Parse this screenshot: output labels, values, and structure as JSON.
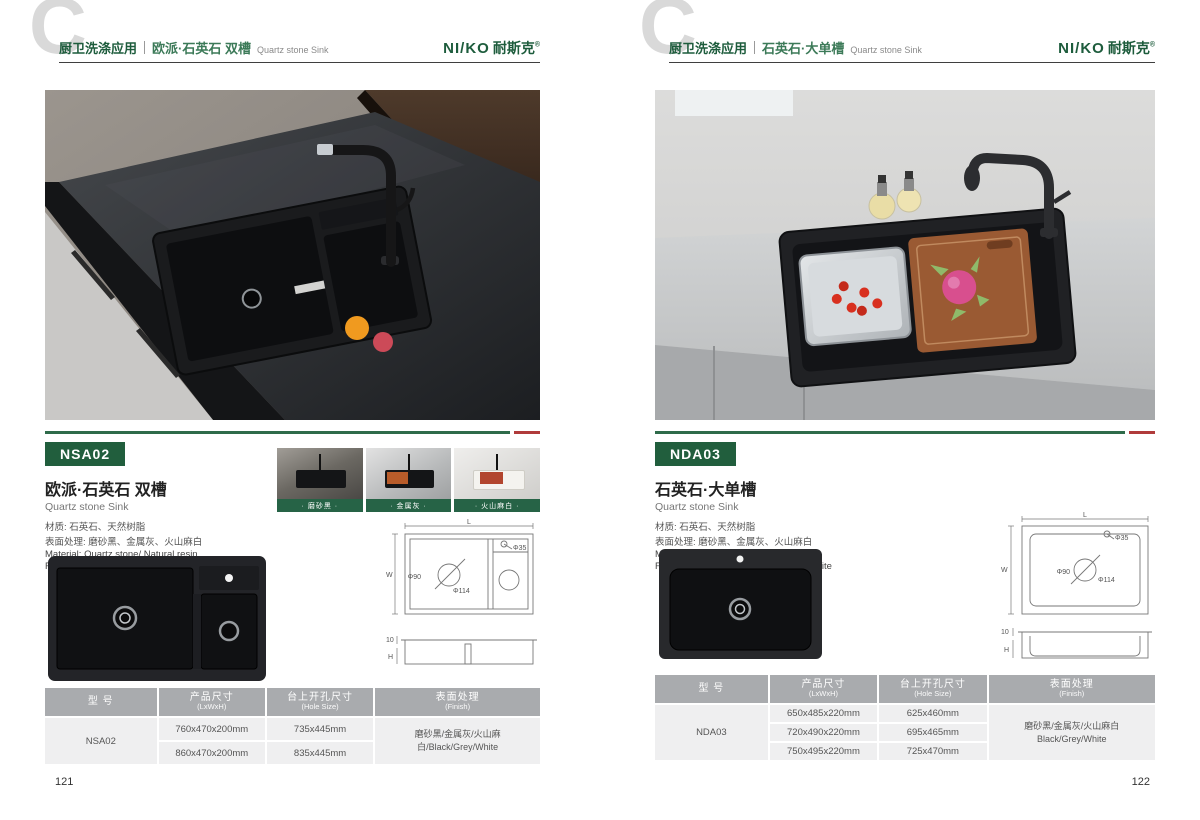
{
  "brand": {
    "logo_latin": "NI/KO",
    "logo_cn": "耐斯克",
    "registered": "®"
  },
  "colors": {
    "brand_green": "#1d5c3c",
    "accent_red": "#b03b3b",
    "table_header_gray": "#a9abae"
  },
  "pages": [
    {
      "page_number": "121",
      "header": {
        "watermark": "C",
        "category": "厨卫洗涤应用",
        "title_cn": "欧派·石英石 双槽",
        "title_en": "Quartz stone Sink"
      },
      "product": {
        "model": "NSA02",
        "name_cn": "欧派·石英石 双槽",
        "name_en": "Quartz stone Sink",
        "material_cn": "材质: 石英石、天然树脂",
        "finish_cn": "表面处理: 磨砂黑、金属灰、火山麻白",
        "material_en": "Material: Quartz stone/ Natural resin",
        "finish_en": "Finish: Frosted black/Metal gray/Dot white"
      },
      "swatches": [
        {
          "label": "· 磨砂黑 ·"
        },
        {
          "label": "· 金属灰 ·"
        },
        {
          "label": "· 火山麻白 ·"
        }
      ],
      "drawing": {
        "length": "L",
        "width": "W",
        "height": "H",
        "lip": "10",
        "hole_faucet": "Φ35",
        "hole_drain": "Φ90",
        "hole_cutout": "Φ114"
      },
      "table": {
        "headers": [
          {
            "cn": "型 号",
            "en": ""
          },
          {
            "cn": "产品尺寸",
            "en": "(LxWxH)"
          },
          {
            "cn": "台上开孔尺寸",
            "en": "(Hole Size)"
          },
          {
            "cn": "表面处理",
            "en": "(Finish)"
          }
        ],
        "model": "NSA02",
        "rows": [
          {
            "size": "760x470x200mm",
            "hole": "735x445mm"
          },
          {
            "size": "860x470x200mm",
            "hole": "835x445mm"
          }
        ],
        "finish_line1": "磨砂黑/金属灰/火山麻白/Black/Grey/White",
        "finish_line2": ""
      }
    },
    {
      "page_number": "122",
      "header": {
        "watermark": "C",
        "category": "厨卫洗涤应用",
        "title_cn": "石英石·大单槽",
        "title_en": "Quartz stone Sink"
      },
      "product": {
        "model": "NDA03",
        "name_cn": "石英石·大单槽",
        "name_en": "Quartz stone Sink",
        "material_cn": "材质: 石英石、天然树脂",
        "finish_cn": "表面处理: 磨砂黑、金属灰、火山麻白",
        "material_en": "Material: Quartz stone/ Natural resin",
        "finish_en": "Finish: Frosted black/Metal gray/Dot white"
      },
      "drawing": {
        "length": "L",
        "width": "W",
        "height": "H",
        "lip": "10",
        "hole_faucet": "Φ35",
        "hole_drain": "Φ90",
        "hole_cutout": "Φ114"
      },
      "table": {
        "headers": [
          {
            "cn": "型 号",
            "en": ""
          },
          {
            "cn": "产品尺寸",
            "en": "(LxWxH)"
          },
          {
            "cn": "台上开孔尺寸",
            "en": "(Hole Size)"
          },
          {
            "cn": "表面处理",
            "en": "(Finish)"
          }
        ],
        "model": "NDA03",
        "rows": [
          {
            "size": "650x485x220mm",
            "hole": "625x460mm"
          },
          {
            "size": "720x490x220mm",
            "hole": "695x465mm"
          },
          {
            "size": "750x495x220mm",
            "hole": "725x470mm"
          }
        ],
        "finish_line1": "磨砂黑/金属灰/火山麻白",
        "finish_line2": "Black/Grey/White"
      }
    }
  ]
}
